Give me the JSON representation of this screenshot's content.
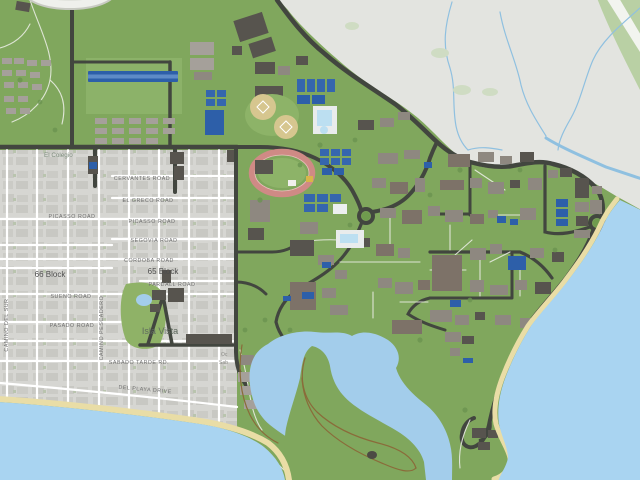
{
  "map": {
    "area_labels": {
      "isla_vista": "Isla Vista",
      "el_colegio": "El Colegio",
      "block_66": "66 Block",
      "block_65": "65 Block"
    },
    "street_labels": {
      "cervantes": "CERVANTES ROAD",
      "el_greco": "EL GRECO ROAD",
      "picasso_east": "PICASSO ROAD",
      "picasso_west": "PICASSO ROAD",
      "segovia": "SEGOVIA ROAD",
      "cordoba": "CORDOBA ROAD",
      "pardall": "PARDALL ROAD",
      "sueno": "SUENO ROAD",
      "pasado": "PASADO ROAD",
      "sabado_tarde": "SABADO TARDE RD.",
      "del_playa": "DEL PLAYA DRIVE",
      "camino_del_sur": "CAMINO DEL SUR",
      "camino_pescadero": "CAMINO PESCADERO"
    },
    "partial_labels": {
      "line1": "Oc",
      "line2": "Sab"
    },
    "colors": {
      "campus_green": "#80a75d",
      "open_area_gray": "#e3e4e0",
      "urban_block_gray": "#d6d6d2",
      "street_white": "#ffffff",
      "road_dark": "#42463f",
      "ocean_blue": "#a9d4f1",
      "lagoon_blue": "#a3cdeb",
      "creek_blue": "#8fc0e0",
      "beach_sand": "#e9dda6",
      "runway_field_green": "#b9d0a4",
      "track_red": "#cf8a85",
      "court_blue": "#3566ae",
      "highlight_blue": "#2d5fa9",
      "building_gray": "#8e8880",
      "building_brown": "#7d7268",
      "building_dark": "#57544e",
      "trail_brown": "#8a6b3a",
      "park_green": "#8fb267",
      "label_gray": "#6f6f6f"
    }
  }
}
